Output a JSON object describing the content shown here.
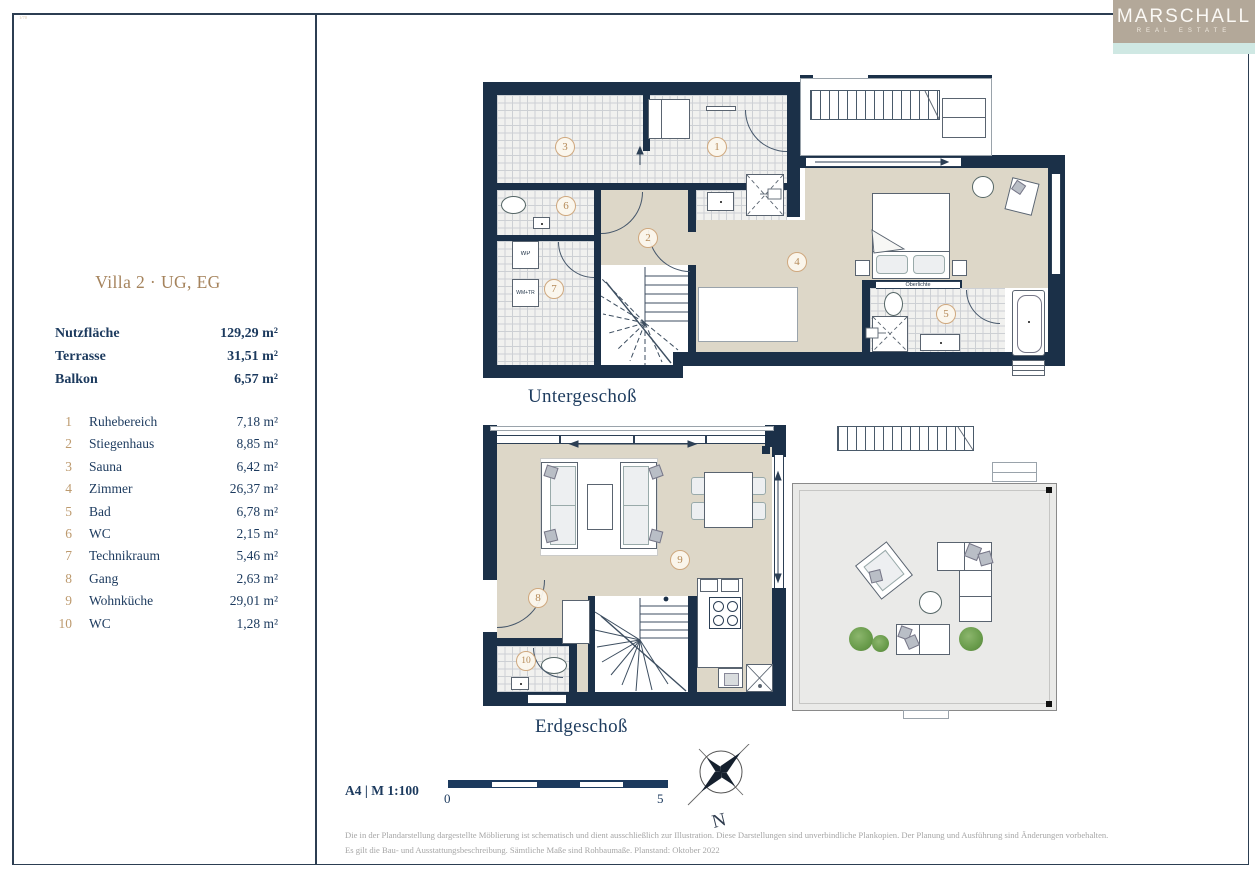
{
  "brand": {
    "name": "MARSCHALL",
    "tagline": "REAL ESTATE"
  },
  "corner_mark": "1/70",
  "panel": {
    "title": "Villa 2 · UG, EG",
    "summary": [
      {
        "label": "Nutzfläche",
        "value": "129,29 m²"
      },
      {
        "label": "Terrasse",
        "value": "31,51 m²"
      },
      {
        "label": "Balkon",
        "value": "6,57 m²"
      }
    ],
    "rooms": [
      {
        "no": "1",
        "name": "Ruhebereich",
        "area": "7,18 m²"
      },
      {
        "no": "2",
        "name": "Stiegenhaus",
        "area": "8,85 m²"
      },
      {
        "no": "3",
        "name": "Sauna",
        "area": "6,42 m²"
      },
      {
        "no": "4",
        "name": "Zimmer",
        "area": "26,37 m²"
      },
      {
        "no": "5",
        "name": "Bad",
        "area": "6,78 m²"
      },
      {
        "no": "6",
        "name": "WC",
        "area": "2,15 m²"
      },
      {
        "no": "7",
        "name": "Technikraum",
        "area": "5,46 m²"
      },
      {
        "no": "8",
        "name": "Gang",
        "area": "2,63 m²"
      },
      {
        "no": "9",
        "name": "Wohnküche",
        "area": "29,01 m²"
      },
      {
        "no": "10",
        "name": "WC",
        "area": "1,28 m²"
      }
    ]
  },
  "plans": {
    "ug": {
      "label": "Untergeschoß",
      "badges": [
        "1",
        "2",
        "3",
        "4",
        "5",
        "6",
        "7"
      ],
      "wp": "WP",
      "wm": "WM+TR",
      "oberlichte": "Oberlichte"
    },
    "eg": {
      "label": "Erdgeschoß",
      "badges": [
        "8",
        "9",
        "10"
      ]
    }
  },
  "footer": {
    "sheet": "A4 | M 1:100",
    "scale_zero": "0",
    "scale_five": "5",
    "north": "N",
    "disclaimer1": "Die in der Plandarstellung dargestellte Möblierung ist schematisch und dient ausschließlich zur Illustration. Diese Darstellungen sind unverbindliche Plankopien. Der Planung und Ausführung sind Änderungen vorbehalten.",
    "disclaimer2": "Es gilt die Bau- und Ausstattungsbeschreibung. Sämtliche Maße sind Rohbaumaße. Planstand: Oktober 2022"
  },
  "colors": {
    "wall": "#1b3048",
    "accent": "#b58a58",
    "beige": "#ddd7c8",
    "tile": "#f1f1ef",
    "terrace": "#eaeae8",
    "teal": "#cfe8e3",
    "taupe": "#b3a899"
  }
}
